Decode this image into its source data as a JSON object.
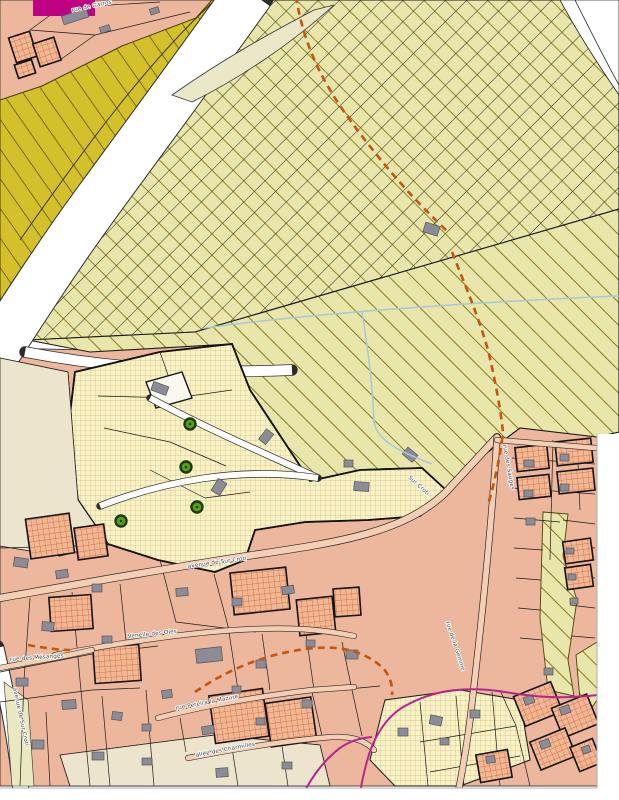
{
  "map": {
    "title": "Cadastral zoning map extract",
    "labels": [
      {
        "text": "rue de Garros"
      },
      {
        "text": "avenue de Sur Croti"
      },
      {
        "text": "Sur Croti"
      },
      {
        "text": "rue des Sauges"
      },
      {
        "text": "Venelle des Oies"
      },
      {
        "text": "rue des Mésanges"
      },
      {
        "text": "rue Pereira la Mazure"
      },
      {
        "text": "allée des Charmilles"
      },
      {
        "text": "rue de la Gemme"
      },
      {
        "text": "avenue de Sur Croti"
      }
    ],
    "colors": {
      "urban_salmon": "#ecb79c",
      "road_fill": "#f5cfb3",
      "rural_hatch_base": "#e9e6ac",
      "hatch_line_olive": "#8a7a1e",
      "hatch_line_black": "#2a2a18",
      "olive_zone": "#d3c02b",
      "olive_zone_line": "#5c4f10",
      "garden_zone_base": "#f7f3c8",
      "garden_grid_orange": "#dd9f55",
      "magenta_dash": "#e23ea6",
      "reserved_parcel_base": "#f2b894",
      "reserved_parcel_grid": "#cd5a35",
      "building_gray": "#8c8c96",
      "tree_green": "#56a01e",
      "stream_blue": "#a5c9d6",
      "path_dashed_orange": "#c4560e",
      "boundary_magenta": "#b5258f",
      "zone_magenta_block": "#c10183",
      "cream": "#ece4cd"
    }
  }
}
